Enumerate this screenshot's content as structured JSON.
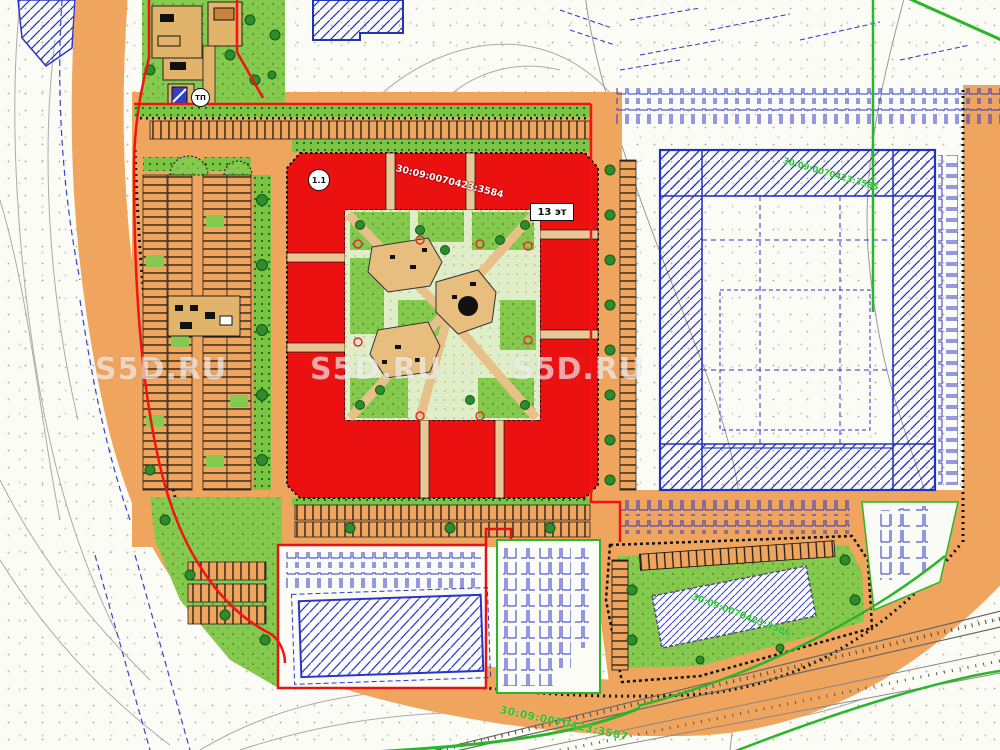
{
  "plan": {
    "labels": {
      "building_number": "1.1",
      "floors": "13 эт",
      "transformer": "ТП"
    },
    "cadastral": {
      "site": "30:09:0070423:3584",
      "east": "30:09:0070423:3585",
      "southeast": "30:09:0070423:3586",
      "south": "30:09:0070423:3587"
    },
    "watermark": "S5D.RU",
    "colors": {
      "road_orange": "#F0A55F",
      "building_red": "#EC1111",
      "boundary_red": "#F51212",
      "lawn_green": "#85C94E",
      "cad_blue": "#2A35C8",
      "cadastral_text_green": "#2EC22E"
    }
  }
}
